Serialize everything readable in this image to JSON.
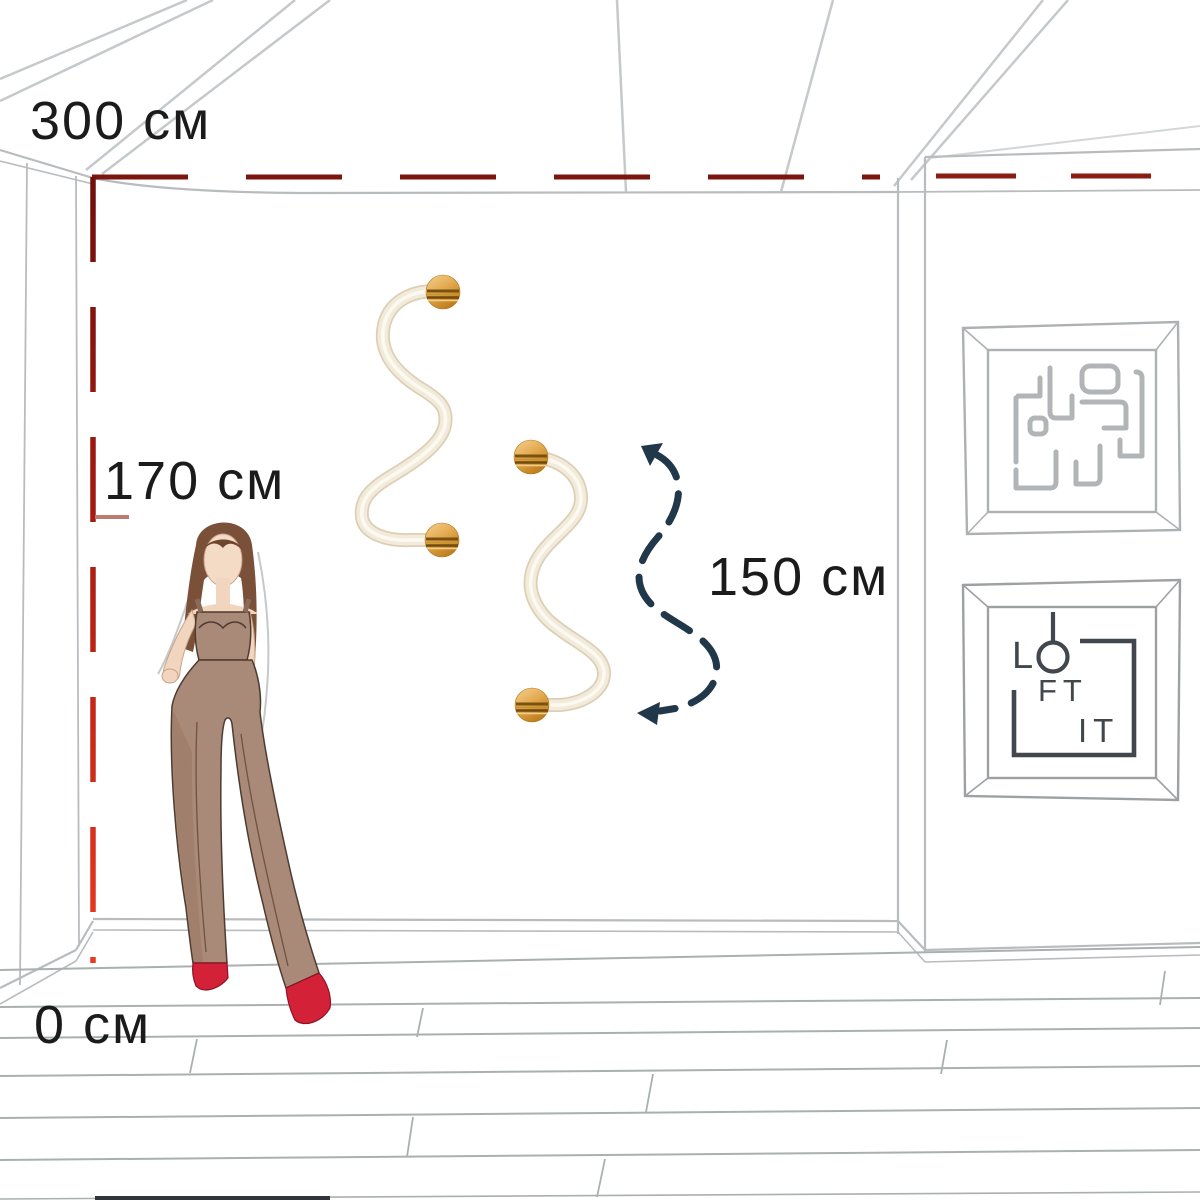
{
  "measurements": {
    "unit": "см",
    "ceiling_height": {
      "value": 300,
      "label": "300 см"
    },
    "mannequin_height": {
      "value": 170,
      "label": "170 см"
    },
    "lamp_span": {
      "value": 150,
      "label": "150 см"
    },
    "floor_level": {
      "value": 0,
      "label": "0 см"
    }
  },
  "brand_logo": {
    "name": "LOFT IT",
    "letter_l": "L",
    "letters_ft": "FT",
    "letters_it": "IT"
  },
  "icons": {
    "wall_lamp": "s-curve-wall-lamp-icon",
    "lamp_mount": "gold-disc-mount-icon",
    "measure_arrow": "s-curve-dashed-arrow-icon",
    "maze_art": "maze-labyrinth-artwork-icon",
    "figure": "fashion-sketch-figure"
  },
  "palette": {
    "measure_red_dark": "#6f100c",
    "measure_red_bright": "#ea3a1f",
    "measure_tick_pink": "#bb7b6f",
    "arrow_navy": "#20384a",
    "lamp_gold": "#d99a43",
    "lamp_tube_cream": "#f1e9d8",
    "sketch_gray": "#bcbfc1",
    "label_text": "#1b1b1b"
  }
}
